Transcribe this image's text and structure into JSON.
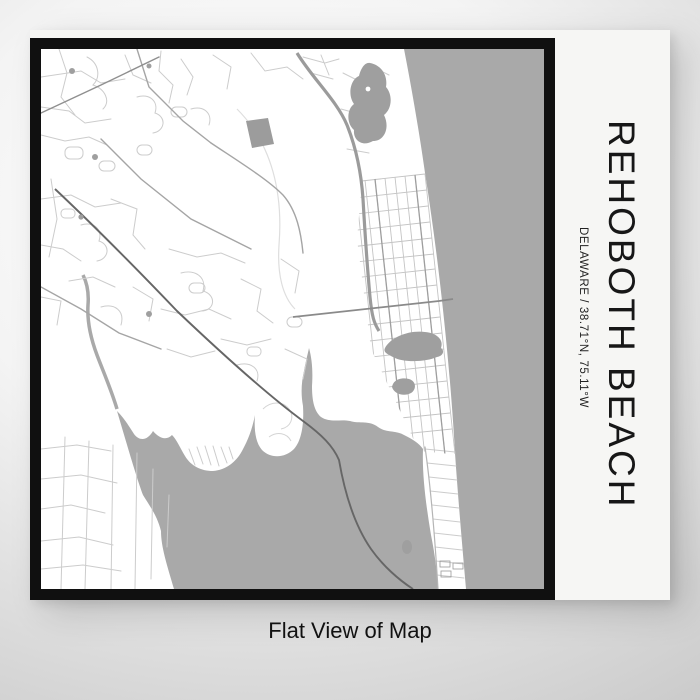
{
  "product": {
    "title": "REHOBOTH BEACH",
    "subtitle": "DELAWARE / 38.71°N, 75.11°W",
    "caption": "Flat View of Map"
  },
  "map": {
    "style": "flat street map",
    "water_features": [
      "ocean-right",
      "bay-bottom",
      "top-pond",
      "silver-lake",
      "small-lake",
      "canal-arm"
    ],
    "land_color": "#ffffff",
    "water_color": "#a9a9a9"
  },
  "colors": {
    "frame": "#101010",
    "paper": "#f6f6f4",
    "water": "#a9a9a9",
    "land": "#ffffff",
    "road_minor": "#cccccc",
    "road_medium": "#a5a5a5",
    "road_major": "#666666",
    "highway": "#9b9b9b",
    "text": "#171717",
    "background_light": "#fdfdfd",
    "background_dark": "#c3c3c3"
  }
}
